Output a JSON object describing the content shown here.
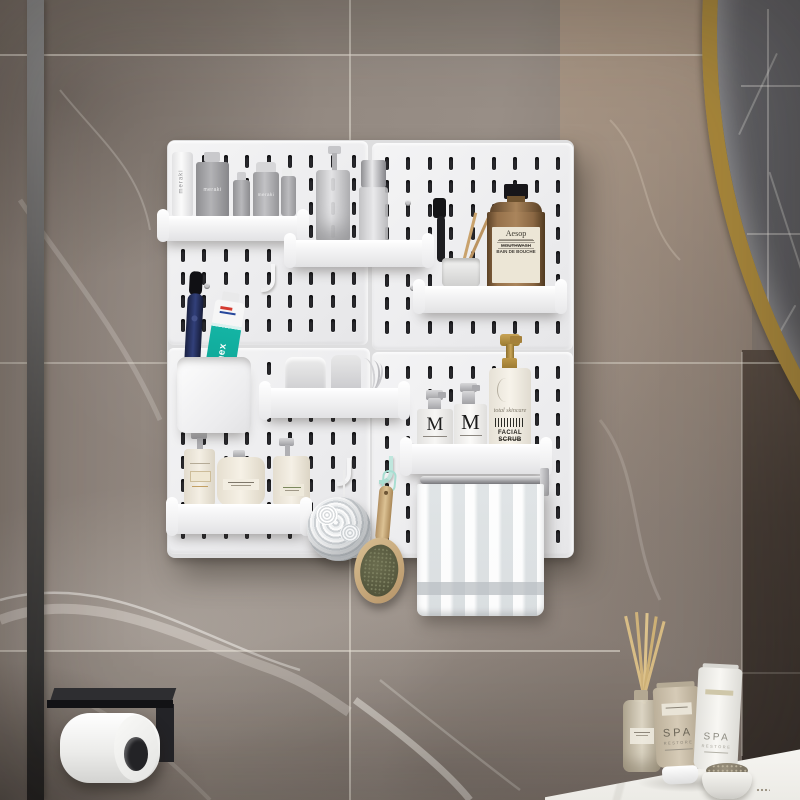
{
  "scene": {
    "description": "Bathroom wall photo: white pegboard organizer with shelves of toiletries on grey marble tile, gold round mirror top right, black toilet-paper holder lower left, spa products on white counter lower right",
    "labels": {
      "meraki_tube": "meraki",
      "meraki_bottle": "meraki",
      "meraki_spray": "meraki",
      "aesop_brand": "Aesop",
      "aesop_line1": "MOUTHWASH",
      "aesop_line2": "BAIN DE BOUCHE",
      "toothpaste": "elmex",
      "m_left": "M",
      "m_right": "M",
      "scrub_script": "total skincare",
      "scrub_name": "FACIAL SCRUB",
      "spa_beige_brand": "SPA",
      "spa_beige_line": "RESTORE",
      "spa_white_brand": "SPA",
      "spa_white_line": "RESTORE"
    },
    "palette": {
      "pegboard_panel": "#f1f1f2",
      "slot": "#2a2a2e",
      "gold_rim": "#a8873b",
      "teal_toothpaste": "#14b4a4",
      "wall_marble": "#8d8278",
      "dark_tile": "#453b34"
    }
  }
}
